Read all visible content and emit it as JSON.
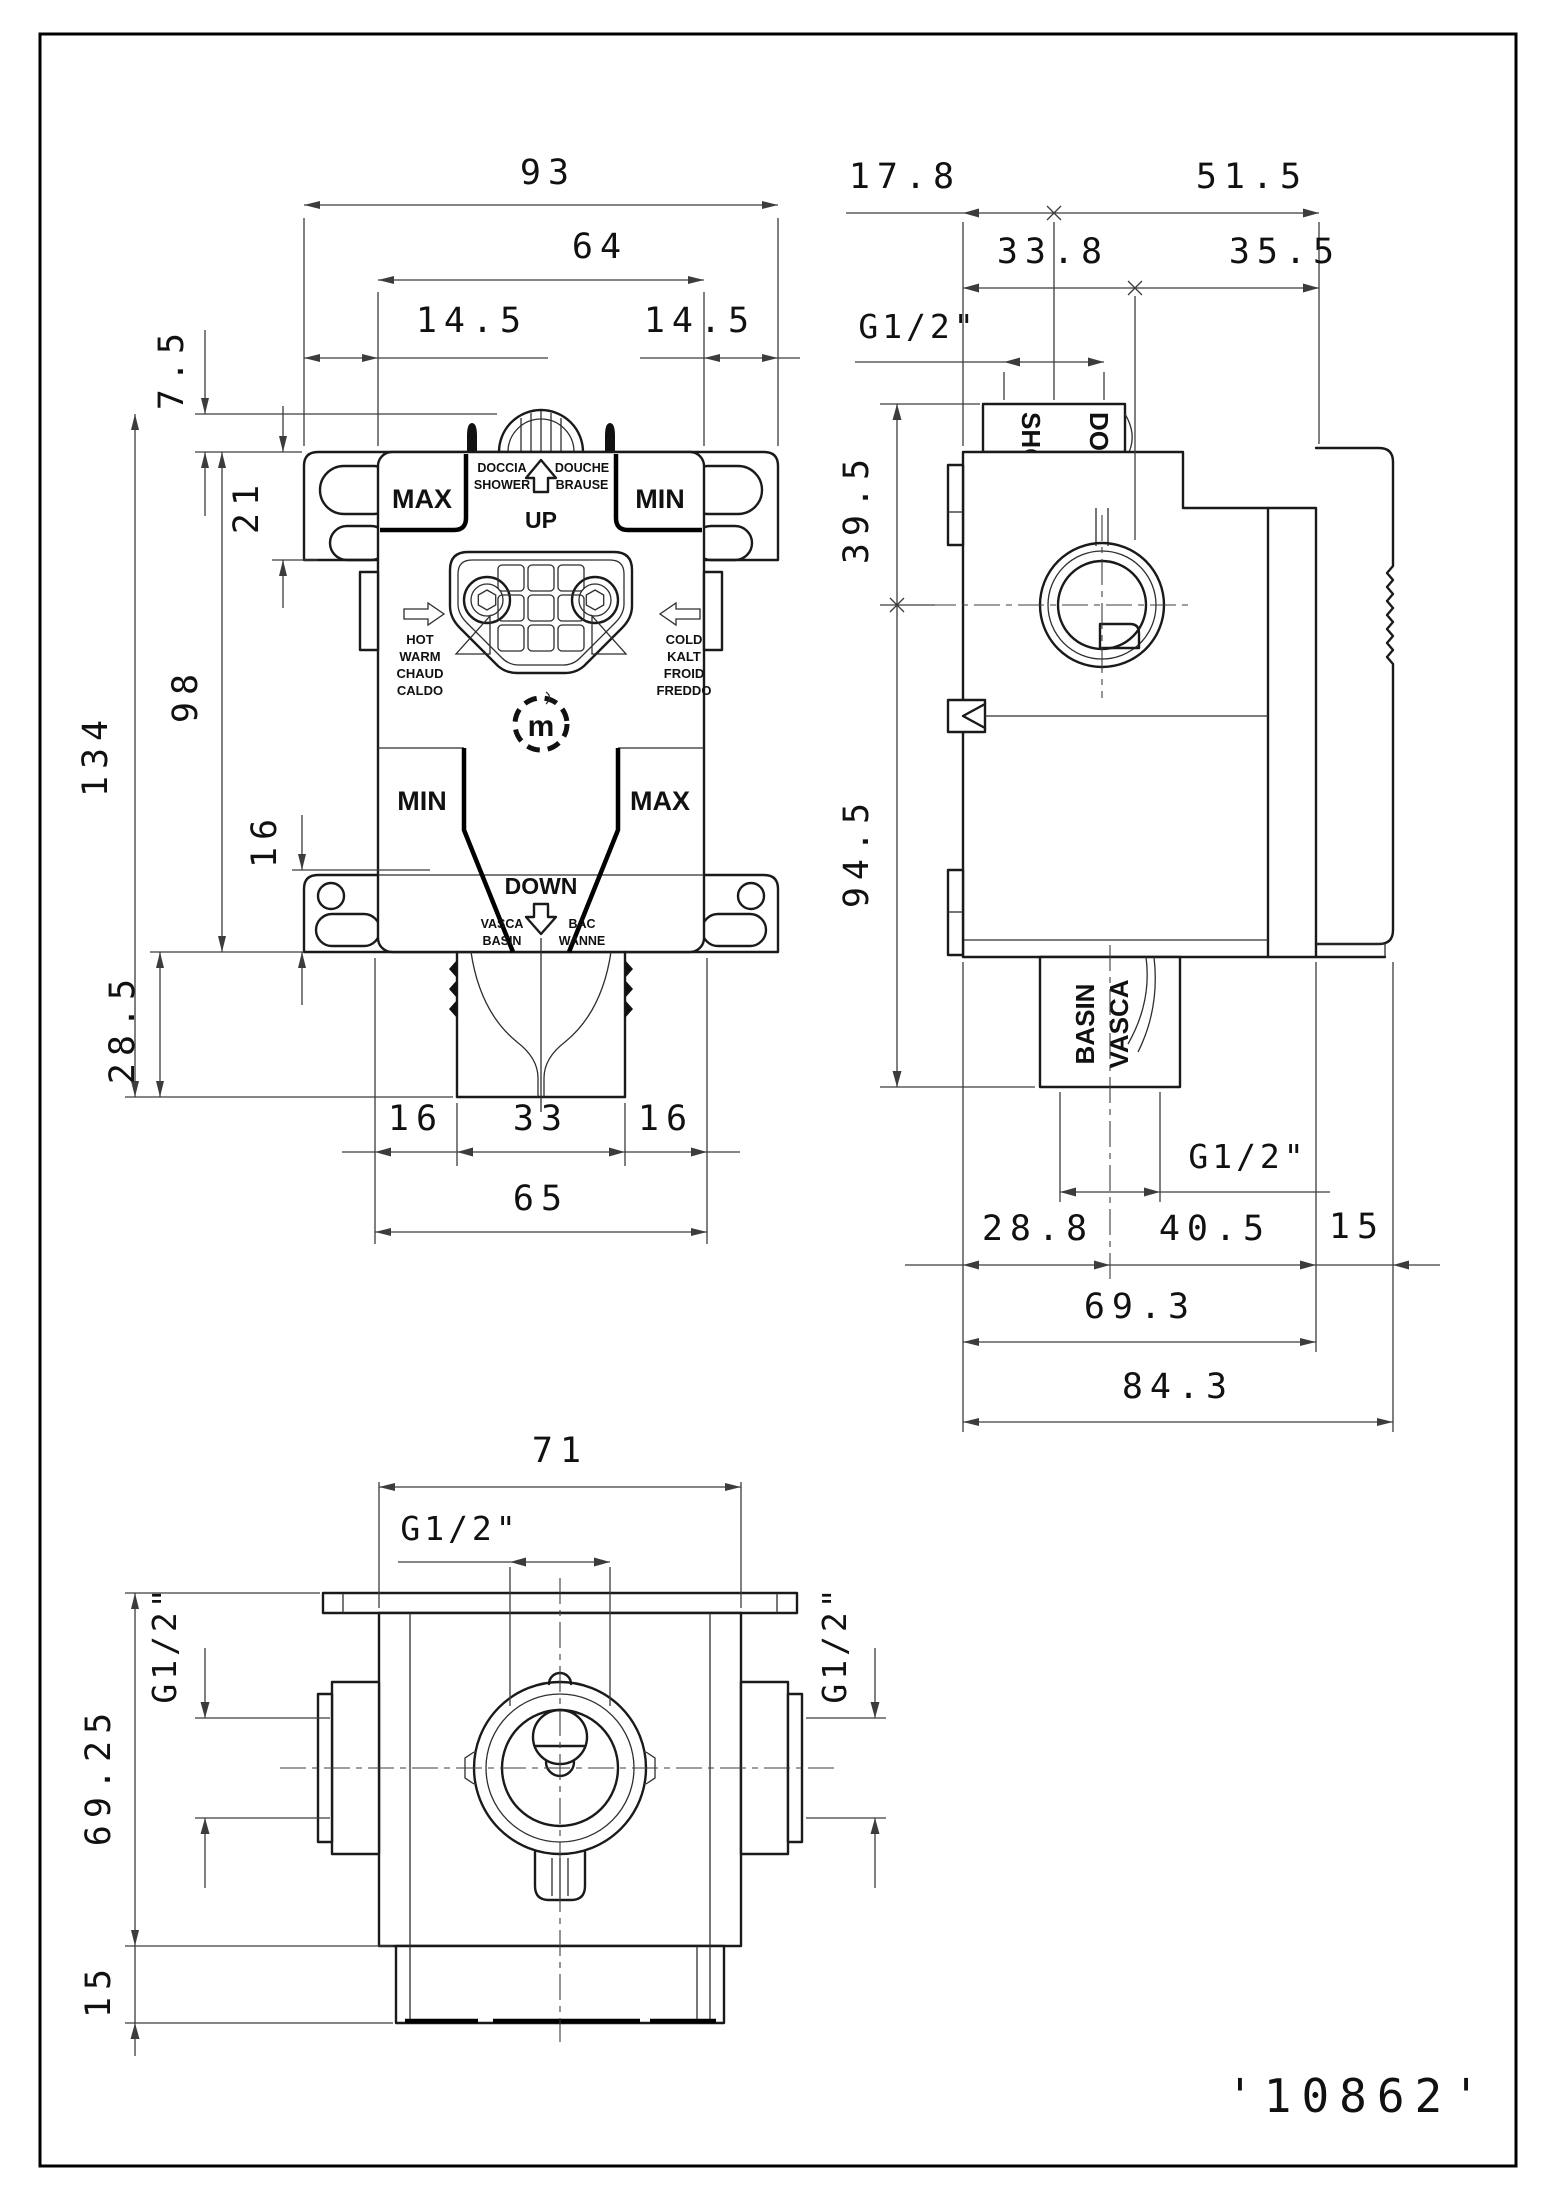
{
  "drawing_number": "'10862'",
  "front": {
    "dims": {
      "total_width": "93",
      "body_width": "64",
      "offset_left": "14.5",
      "offset_right": "14.5",
      "stub_height": "7.5",
      "slot_depth": "21",
      "body_height": "98",
      "total_height": "134",
      "flange_step": "16",
      "outlet_drop": "28.5",
      "outlet_left": "16",
      "outlet_width": "33",
      "outlet_right": "16",
      "outlet_span": "65"
    },
    "labels": {
      "max_top": "MAX",
      "min_top": "MIN",
      "doccia": "DOCCIA",
      "shower": "SHOWER",
      "douche": "DOUCHE",
      "brause": "BRAUSE",
      "up": "UP",
      "hot": "HOT",
      "warm": "WARM",
      "chaud": "CHAUD",
      "caldo": "CALDO",
      "cold": "COLD",
      "kalt": "KALT",
      "froid": "FROID",
      "freddo": "FREDDO",
      "min_bottom": "MIN",
      "max_bottom": "MAX",
      "down": "DOWN",
      "vasca": "VASCA",
      "basin": "BASIN",
      "bac": "BAC",
      "wanne": "WANNE",
      "logo_letter": "m"
    }
  },
  "side": {
    "dims": {
      "pipe_offset": "17.8",
      "pipe_to_face": "51.5",
      "face_to_center": "33.8",
      "center_to_face": "35.5",
      "thread_top": "G1/2\"",
      "center_height": "39.5",
      "body_drop": "94.5",
      "thread_bottom": "G1/2\"",
      "outlet_offset": "28.8",
      "outlet_to_cap": "40.5",
      "cap_width": "15",
      "body_depth": "69.3",
      "total_depth": "84.3"
    },
    "labels": {
      "marking_top_1": "SHOWER",
      "marking_top_2": "DOCCIA",
      "marking_bottom_1": "BASIN",
      "marking_bottom_2": "VASCA"
    }
  },
  "top": {
    "dims": {
      "body_width": "71",
      "thread_center": "G1/2\"",
      "thread_left": "G1/2\"",
      "thread_right": "G1/2\"",
      "depth_to_flange": "69.25",
      "base_depth": "15"
    }
  }
}
